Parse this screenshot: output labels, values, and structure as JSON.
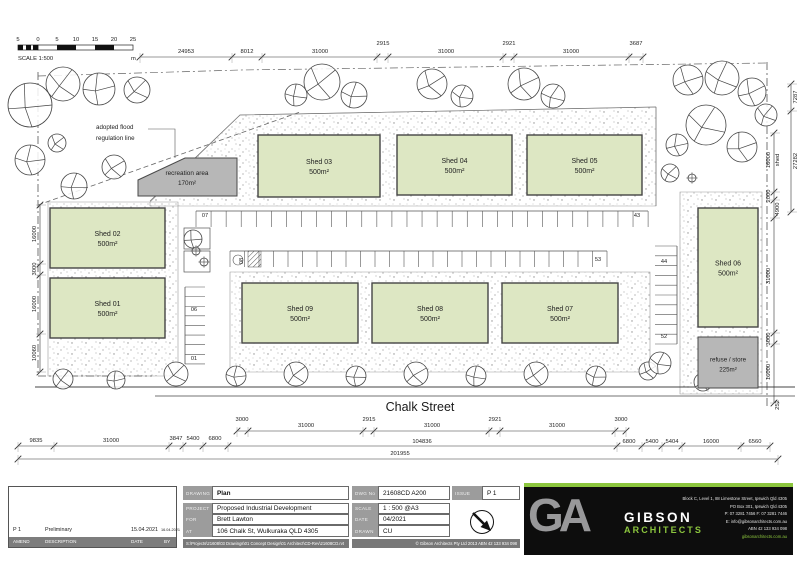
{
  "scalebar": {
    "labels": [
      "5",
      "0",
      "5",
      "10",
      "15",
      "20",
      "25"
    ],
    "unit": "m",
    "caption": "SCALE 1:500"
  },
  "street": {
    "name": "Chalk Street"
  },
  "flood_label": {
    "line1": "adopted flood",
    "line2": "regulation line"
  },
  "areas": {
    "recreation": {
      "label": "recreation area",
      "area": "170m²"
    },
    "refuse": {
      "label": "refuse / store",
      "area": "225m²"
    }
  },
  "plan": {
    "shed_fill": "#dde7c3",
    "gray_fill": "#b7b7b7",
    "line_color": "#3a3a3a",
    "sheds": [
      {
        "label": "Shed 03",
        "area": "500m²",
        "x": 258,
        "y": 135,
        "w": 122,
        "h": 62
      },
      {
        "label": "Shed 04",
        "area": "500m²",
        "x": 397,
        "y": 135,
        "w": 115,
        "h": 60
      },
      {
        "label": "Shed 05",
        "area": "500m²",
        "x": 527,
        "y": 135,
        "w": 115,
        "h": 60
      },
      {
        "label": "Shed 02",
        "area": "500m²",
        "x": 50,
        "y": 208,
        "w": 115,
        "h": 60
      },
      {
        "label": "Shed 01",
        "area": "500m²",
        "x": 50,
        "y": 278,
        "w": 115,
        "h": 60
      },
      {
        "label": "Shed 09",
        "area": "500m²",
        "x": 242,
        "y": 283,
        "w": 116,
        "h": 60
      },
      {
        "label": "Shed 08",
        "area": "500m²",
        "x": 372,
        "y": 283,
        "w": 116,
        "h": 60
      },
      {
        "label": "Shed 07",
        "area": "500m²",
        "x": 502,
        "y": 283,
        "w": 116,
        "h": 60
      },
      {
        "label": "Shed 06",
        "area": "500m²",
        "x": 698,
        "y": 208,
        "w": 60,
        "h": 119
      }
    ],
    "recreation_poly": "138,180 185,158 237,158 237,196 138,196",
    "refuse_rect": {
      "x": 698,
      "y": 337,
      "w": 60,
      "h": 51
    },
    "bands": [
      "150,202 240,115 656,107 656,206 150,206",
      "48,202 178,202 178,376 48,376",
      "230,272 650,272 650,372 230,372",
      "680,192 762,192 762,394 680,394"
    ],
    "lines": [
      {
        "pts": "38,72 38,376 152,376",
        "dash": "8 3 2 3",
        "c": "#555",
        "w": 0.8
      },
      {
        "pts": "767,62 767,408",
        "dash": "8 3 2 3",
        "c": "#555",
        "w": 0.8
      },
      {
        "pts": "38,76 240,70 767,63",
        "dash": "8 3 2 3",
        "c": "#666",
        "w": 0.7
      },
      {
        "pts": "38,205 300,112",
        "dash": "5 3",
        "c": "#666",
        "w": 0.8
      },
      {
        "pts": "150,201 240,115 656,107",
        "dash": "",
        "c": "#777",
        "w": 0.7
      },
      {
        "pts": "656,107 656,206",
        "dash": "",
        "c": "#777",
        "w": 0.7
      },
      {
        "pts": "35,387 795,387",
        "dash": "",
        "c": "#444",
        "w": 1
      },
      {
        "pts": "155,396 795,396",
        "dash": "",
        "c": "#444",
        "w": 0.8
      },
      {
        "pts": "148,129 175,129 175,158",
        "dash": "",
        "c": "#555",
        "w": 0.6
      }
    ],
    "structures": [
      {
        "x": 184,
        "y": 228,
        "w": 26,
        "h": 21,
        "hatch": false
      },
      {
        "x": 184,
        "y": 251,
        "w": 26,
        "h": 21,
        "hatch": false
      }
    ],
    "trees": [
      [
        30,
        105,
        22
      ],
      [
        63,
        84,
        17
      ],
      [
        99,
        89,
        16
      ],
      [
        137,
        90,
        13
      ],
      [
        30,
        160,
        15
      ],
      [
        57,
        143,
        9
      ],
      [
        74,
        186,
        13
      ],
      [
        114,
        167,
        12
      ],
      [
        296,
        95,
        11
      ],
      [
        322,
        82,
        18
      ],
      [
        354,
        95,
        13
      ],
      [
        432,
        84,
        15
      ],
      [
        462,
        96,
        11
      ],
      [
        524,
        84,
        16
      ],
      [
        553,
        96,
        12
      ],
      [
        688,
        80,
        15
      ],
      [
        722,
        78,
        17
      ],
      [
        752,
        92,
        14
      ],
      [
        706,
        125,
        20
      ],
      [
        742,
        147,
        15
      ],
      [
        766,
        115,
        11
      ],
      [
        677,
        145,
        11
      ],
      [
        670,
        173,
        9
      ],
      [
        193,
        239,
        9
      ],
      [
        63,
        379,
        10
      ],
      [
        116,
        380,
        9
      ],
      [
        176,
        374,
        12
      ],
      [
        236,
        376,
        10
      ],
      [
        296,
        374,
        12
      ],
      [
        356,
        376,
        10
      ],
      [
        416,
        374,
        12
      ],
      [
        476,
        376,
        10
      ],
      [
        536,
        374,
        12
      ],
      [
        596,
        376,
        10
      ],
      [
        648,
        371,
        9
      ],
      [
        660,
        363,
        11
      ],
      [
        703,
        382,
        9
      ],
      [
        113,
        295,
        4
      ],
      [
        196,
        251,
        4
      ],
      [
        692,
        178,
        4
      ],
      [
        204,
        262,
        4
      ]
    ],
    "parking": {
      "rows": [
        {
          "type": "h",
          "a": 196,
          "b": 648,
          "pos": 211,
          "len": 16,
          "step": 15.07
        },
        {
          "type": "h",
          "a": 230,
          "b": 607,
          "pos": 251,
          "len": 16,
          "step": 14.5
        },
        {
          "type": "v",
          "a": 246,
          "b": 344,
          "pos": 677,
          "len": -22,
          "step": 9.8
        },
        {
          "type": "v",
          "a": 287,
          "b": 364,
          "pos": 185,
          "len": 20,
          "step": 9.62
        }
      ],
      "labels": [
        {
          "t": "07",
          "x": 205,
          "y": 217
        },
        {
          "t": "43",
          "x": 637,
          "y": 217
        },
        {
          "t": "08",
          "x": 243,
          "y": 261,
          "rot": true
        },
        {
          "t": "53",
          "x": 598,
          "y": 261
        },
        {
          "t": "44",
          "x": 664,
          "y": 263
        },
        {
          "t": "52",
          "x": 664,
          "y": 338
        },
        {
          "t": "06",
          "x": 194,
          "y": 311
        },
        {
          "t": "01",
          "x": 194,
          "y": 360
        }
      ],
      "hatch_bay": {
        "x": 248,
        "y": 251,
        "w": 13,
        "h": 16
      },
      "circle_bay": {
        "cx": 238,
        "cy": 260,
        "r": 5
      }
    },
    "dims": {
      "h": [
        {
          "y": 57,
          "ticks": [
            140,
            232,
            262,
            377,
            388,
            503,
            514,
            629,
            643
          ],
          "labels": [
            {
              "t": "24953",
              "x": 186
            },
            {
              "t": "8012",
              "x": 247
            },
            {
              "t": "31000",
              "x": 320
            },
            {
              "t": "2915",
              "x": 383,
              "dy": -12
            },
            {
              "t": "31000",
              "x": 446
            },
            {
              "t": "2921",
              "x": 509,
              "dy": -12
            },
            {
              "t": "31000",
              "x": 571
            },
            {
              "t": "3687",
              "x": 636,
              "dy": -12
            }
          ]
        },
        {
          "y": 431,
          "ticks": [
            237,
            248,
            363,
            374,
            489,
            500,
            615,
            626
          ],
          "labels": [
            {
              "t": "3000",
              "x": 242,
              "dy": -10
            },
            {
              "t": "31000",
              "x": 306
            },
            {
              "t": "2915",
              "x": 369,
              "dy": -10
            },
            {
              "t": "31000",
              "x": 432
            },
            {
              "t": "2921",
              "x": 495,
              "dy": -10
            },
            {
              "t": "31000",
              "x": 557
            },
            {
              "t": "3000",
              "x": 621,
              "dy": -10
            }
          ]
        },
        {
          "y": 446,
          "ticks": [
            18,
            54,
            169,
            183,
            203,
            228,
            617,
            642,
            662,
            682,
            741,
            770
          ],
          "labels": [
            {
              "t": "9835",
              "x": 36
            },
            {
              "t": "31000",
              "x": 111
            },
            {
              "t": "3847",
              "x": 176,
              "dy": -6
            },
            {
              "t": "5400",
              "x": 193,
              "dy": -6
            },
            {
              "t": "6800",
              "x": 215,
              "dy": -6
            },
            {
              "t": "104836",
              "x": 422,
              "dy": -3
            },
            {
              "t": "6800",
              "x": 629,
              "dy": -3
            },
            {
              "t": "5400",
              "x": 652,
              "dy": -3
            },
            {
              "t": "5404",
              "x": 672,
              "dy": -3
            },
            {
              "t": "16000",
              "x": 711,
              "dy": -3
            },
            {
              "t": "6560",
              "x": 755,
              "dy": -3
            }
          ]
        },
        {
          "y": 459,
          "ticks": [
            18,
            778
          ],
          "labels": [
            {
              "t": "201955",
              "x": 400,
              "dy": -4
            }
          ]
        }
      ],
      "v": [
        {
          "x": 40,
          "ticks": [
            205,
            264,
            275,
            334,
            372
          ],
          "labels": [
            {
              "t": "16000",
              "y": 234
            },
            {
              "t": "3000",
              "y": 269
            },
            {
              "t": "16000",
              "y": 304
            },
            {
              "t": "10060",
              "y": 353
            }
          ]
        },
        {
          "x": 774,
          "ticks": [
            133,
            192,
            200,
            218,
            333,
            344,
            403
          ],
          "labels": [
            {
              "t": "16000",
              "y": 160
            },
            {
              "t": "shed",
              "y": 160,
              "dx": 5
            },
            {
              "t": "2000",
              "y": 196
            },
            {
              "t": "4900",
              "y": 209,
              "dx": 5
            },
            {
              "t": "31000",
              "y": 276
            },
            {
              "t": "3000",
              "y": 339
            },
            {
              "t": "16000",
              "y": 372
            },
            {
              "t": "252",
              "y": 405,
              "dx": 5
            }
          ]
        },
        {
          "x": 791,
          "ticks": [
            84,
            111,
            212
          ],
          "labels": [
            {
              "t": "7287",
              "y": 97,
              "dx": 6
            },
            {
              "t": "27282",
              "y": 161,
              "dx": 6
            }
          ]
        }
      ]
    }
  },
  "titleblock": {
    "drawing_label": "DRAWING",
    "drawing": "Plan",
    "dwg_label": "DWG No",
    "dwg": "21608CD  A200",
    "issue_label": "ISSUE",
    "issue": "P 1",
    "project_label": "PROJECT",
    "project": "Proposed Industrial Development",
    "for_label": "FOR",
    "client": "Brett Lawton",
    "at_label": "AT",
    "address": "106 Chalk St, Wulkuraka QLD 4305",
    "scale_label": "SCALE",
    "scale": "1 : 500  @A3",
    "date_label": "DATE",
    "date": "04/2021",
    "drawn_label": "DRAWN",
    "drawn": "CU",
    "path": "S:\\Projects\\21608\\03 Drawings\\01 Concept Design\\01 Architect\\CD-Rev\\21608CD.rvt",
    "copyright": "© Gibson Architects Pty Ltd 2013 ABN 42 133 934 098",
    "revision": {
      "issue": "P 1",
      "description": "Preliminary",
      "date": "15.04.2021",
      "stamp": "16.04.2021"
    },
    "rev_headers": [
      "AMEND",
      "DESCRIPTION",
      "DATE",
      "BY"
    ]
  },
  "logo": {
    "ga": "GA",
    "name1": "GIBSON",
    "name2": "ARCHITECTS",
    "green": "#8cc63e",
    "address_lines": [
      "Block C, Level 1, 88 Limestone Street, Ipswich Qld 4305",
      "PO Box 301, Ipswich Qld 4305",
      "P: 07 3281 7456   F: 07 3281 7446",
      "E: info@gibsonarchitects.com.au",
      "ABN 42 133 934 098",
      "gibsonarchitects.com.au"
    ]
  }
}
